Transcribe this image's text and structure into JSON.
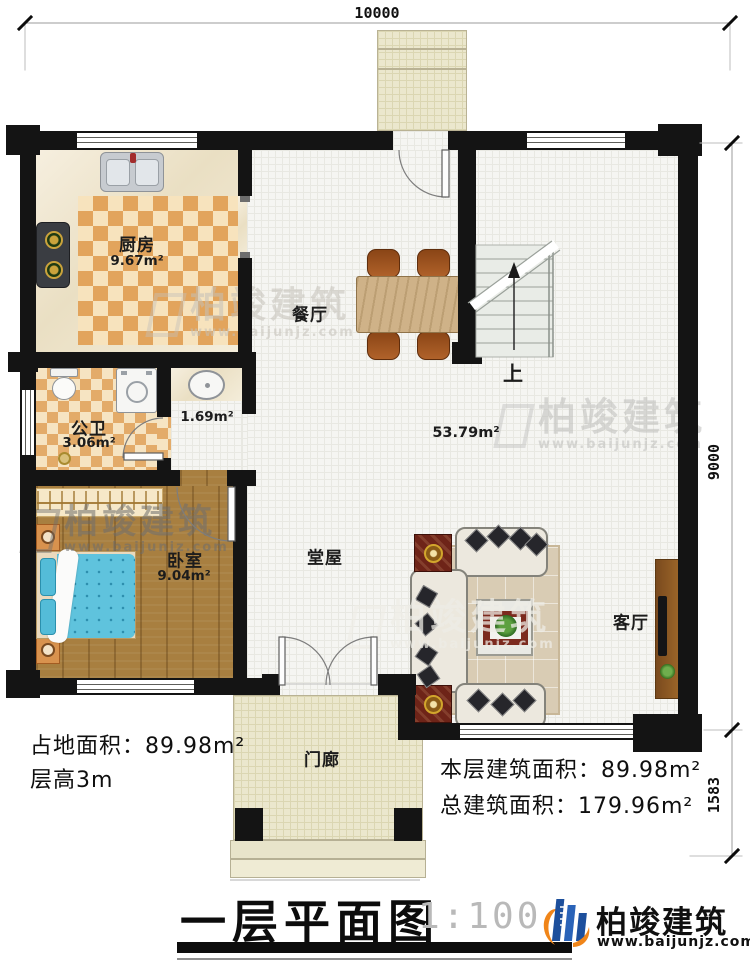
{
  "dimensions": {
    "top": "10000",
    "right_main": "9000",
    "right_porch": "1583"
  },
  "rooms": {
    "kitchen": {
      "name": "厨房",
      "area": "9.67m²"
    },
    "bathroom": {
      "name": "公卫",
      "area": "3.06m²"
    },
    "vanity": {
      "area": "1.69m²"
    },
    "bedroom": {
      "name": "卧室",
      "area": "9.04m²"
    },
    "dining": {
      "name": "餐厅"
    },
    "hall": {
      "name": "堂屋",
      "area": "53.79m²"
    },
    "living": {
      "name": "客厅"
    },
    "porch": {
      "name": "门廊"
    }
  },
  "stairs": {
    "direction_label": "上"
  },
  "annotations": {
    "site_area": "占地面积：89.98m²",
    "floor_height": "层高3m",
    "floor_area": "本层建筑面积：89.98m²",
    "total_area": "总建筑面积：179.96m²"
  },
  "title": {
    "text": "一层平面图",
    "scale": "1:100"
  },
  "brand": {
    "name": "柏竣建筑",
    "website": "www.baijunjz.com"
  },
  "watermark": {
    "name": "柏竣建筑",
    "website": "www.baijunjz.com"
  },
  "colors": {
    "wall": "#141414",
    "kitchen_tile_dark": "#e2a45c",
    "kitchen_tile_light": "#f7e3bd",
    "wood_floor": "#a87f40",
    "accent_blue": "#1d4f9c",
    "accent_orange": "#f08519"
  }
}
